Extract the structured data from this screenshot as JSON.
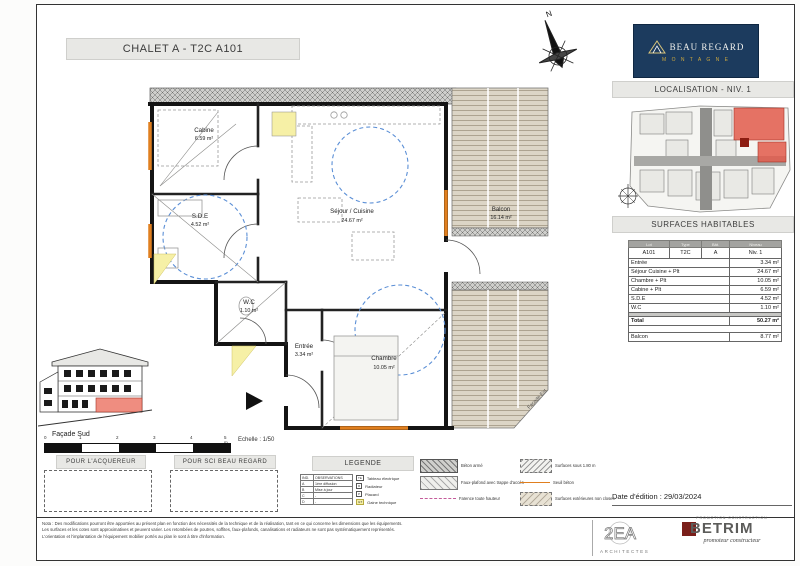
{
  "title": "CHALET A - T2C A101",
  "brand": {
    "name": "BEAU REGARD",
    "sub": "M O N T A G N E"
  },
  "headers": {
    "localisation": "LOCALISATION - NIV. 1",
    "surfaces": "SURFACES HABITABLES"
  },
  "compass": {
    "n": "N"
  },
  "rooms": {
    "cabine": {
      "name": "Cabine",
      "area": "6.59 m²"
    },
    "sde": {
      "name": "S.D.E",
      "area": "4.52 m²"
    },
    "wc": {
      "name": "W.C",
      "area": "1.10 m²"
    },
    "entree": {
      "name": "Entrée",
      "area": "3.34 m²"
    },
    "sejour": {
      "name": "Séjour / Cuisine",
      "area": "24.67 m²"
    },
    "chambre": {
      "name": "Chambre",
      "area": "10.05 m²"
    },
    "balcon": {
      "name": "Balcon",
      "area": "16.14 m²"
    },
    "facade_est": "Façade Est"
  },
  "table": {
    "cols": [
      "Lot",
      "Type",
      "Bât.",
      "Niveau"
    ],
    "unit": [
      "A101",
      "T2C",
      "A",
      "Niv. 1"
    ],
    "rows": [
      {
        "label": "Entrée",
        "value": "3.34 m²"
      },
      {
        "label": "Séjour Cuisine + Plt",
        "value": "24.67 m²"
      },
      {
        "label": "Chambre + Plt",
        "value": "10.05 m²"
      },
      {
        "label": "Cabine + Plt",
        "value": "6.59 m²"
      },
      {
        "label": "S.D.E",
        "value": "4.52 m²"
      },
      {
        "label": "W.C",
        "value": "1.10 m²"
      }
    ],
    "total": {
      "label": "Total",
      "value": "50.27 m²"
    },
    "balcon": {
      "label": "Balcon",
      "value": "8.77 m²"
    }
  },
  "date": "Date d'édition : 29/03/2024",
  "facade": {
    "label": "Façade Sud",
    "scale": "Echelle : 1/50"
  },
  "scalebar": {
    "ticks": [
      "0",
      "1",
      "2",
      "3",
      "4",
      "5 m"
    ]
  },
  "sign": {
    "acquereur": "POUR L'ACQUEREUR",
    "sci": "POUR SCI BEAU REGARD"
  },
  "legend": {
    "title": "LEGENDE",
    "rev": {
      "h0": "IND.",
      "h1": "OBSERVATIONS",
      "rows": [
        [
          "A",
          "1ère diffusion"
        ],
        [
          "B",
          "Mise à jour"
        ],
        [
          "C",
          "-"
        ],
        [
          "D",
          "-"
        ]
      ]
    },
    "symbols": [
      {
        "key": "TE",
        "label": "Tableau électrique"
      },
      {
        "key": "R",
        "label": "Radiateur"
      },
      {
        "key": "P",
        "label": "Placard"
      },
      {
        "key": "GT",
        "label": "Gaine technique"
      }
    ],
    "swA": [
      {
        "label": "Béton armé"
      },
      {
        "label": "Faux-plafond avec trappe d'accès"
      },
      {
        "label": "Faïence toute hauteur"
      }
    ],
    "swB": [
      {
        "label": "Surfaces sous 1.80 m"
      },
      {
        "label": "Seuil béton"
      },
      {
        "label": "Surfaces extérieures non closes"
      }
    ]
  },
  "disclaimer": [
    "Nota : Des modifications pourront être apportées au présent plan en fonction des nécessités de la technique et de la réalisation, tant en ce qui concerne les dimensions que les équipements.",
    "Les surfaces et les cotes sont approximatives et peuvent varier. Les retombées de poutres, soffites, faux-plafonds, canalisations et radiateurs ne sont pas systématiquement représentés.",
    "L'orientation et l'implantation de l'équipement mobilier portés au plan le sont à titre d'information."
  ],
  "logos": {
    "arch": "2EA",
    "arch_sub": "ARCHITECTES",
    "builder": "BETRIM",
    "builder_top": "PROMOTION CONSTRUCTION",
    "builder_tag": "promoteur constructeur"
  }
}
